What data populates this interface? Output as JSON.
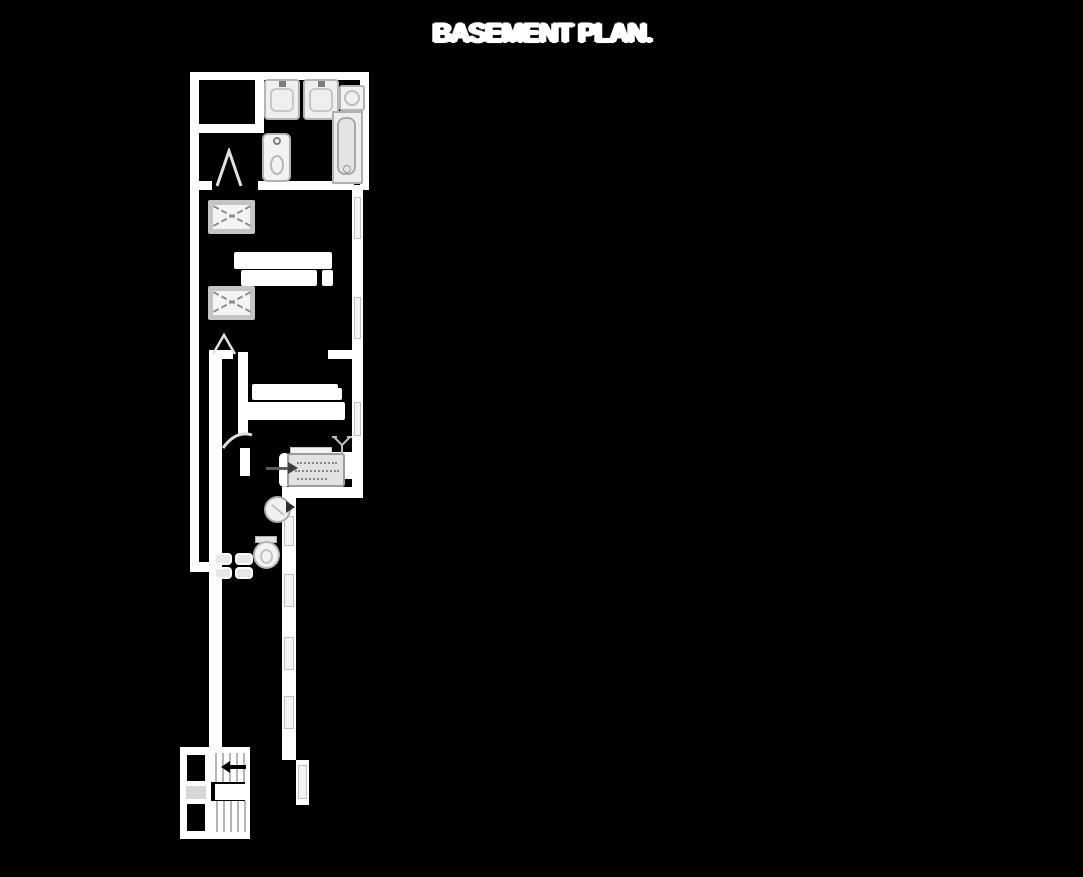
{
  "title": "BASEMENT PLAN.",
  "colors": {
    "background": "#000000",
    "walls": "#ffffff",
    "fixture_fill": "#ececec",
    "fixture_line": "#a8a8a8",
    "window_fill": "#f3f3f3"
  },
  "plan": {
    "style": "inverted blueprint (white line-work on black)",
    "fixtures": [
      "closet-room",
      "closet-room",
      "vanity-sink",
      "vanity-sink",
      "washer",
      "toilet",
      "bathtub",
      "bed-with-x",
      "bed-with-x",
      "illegible-room-label",
      "illegible-room-label",
      "furnace-unit",
      "valve-symbol",
      "vent-fan-circle",
      "toilet",
      "double-laundry-sink",
      "corridor-windows",
      "staircase-upper-run",
      "staircase-landing",
      "staircase-lower-run",
      "stair-direction-arrow",
      "storage-column",
      "door-swing",
      "door-swing",
      "door-swing"
    ],
    "window_count": 9,
    "label_blobs": 2
  }
}
